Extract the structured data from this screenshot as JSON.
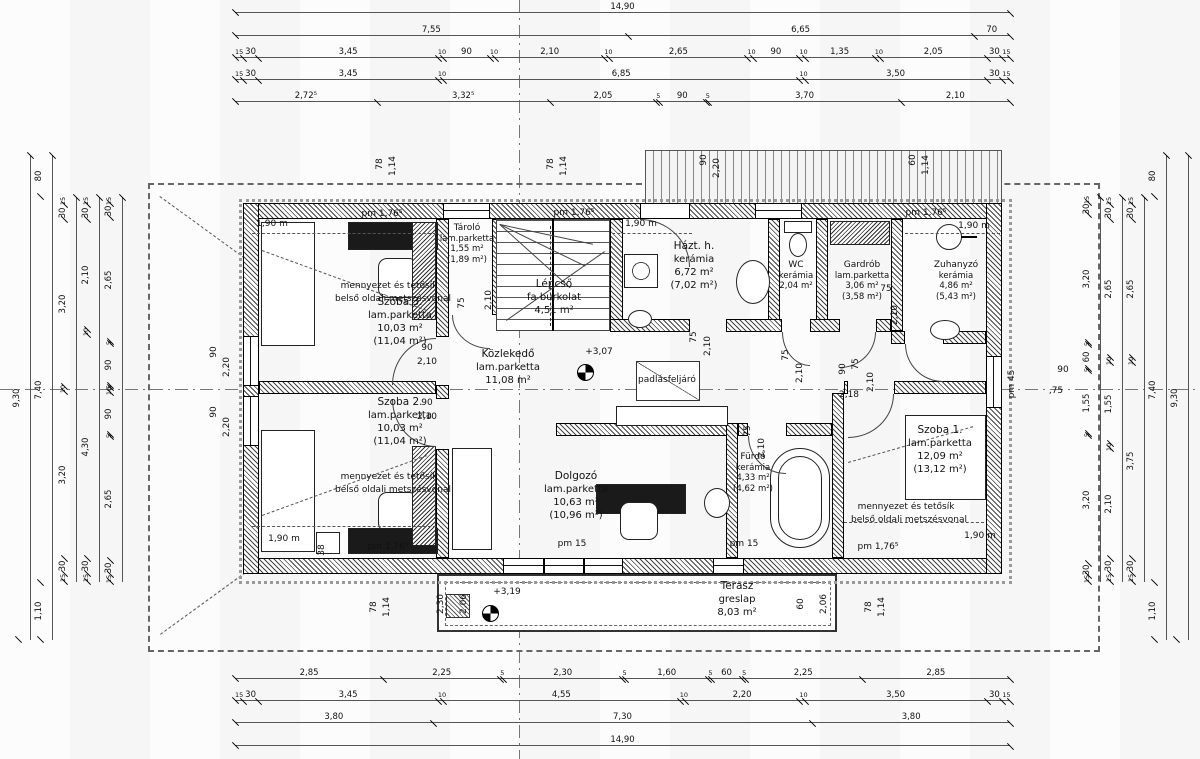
{
  "rooms": [
    {
      "name": "Szoba 3.",
      "finish": "lam.parketta",
      "area": "10,03 m²",
      "area2": "(11,04 m²)"
    },
    {
      "name": "Tároló",
      "finish": "lam.parketta",
      "area": "1,55 m²",
      "area2": "(1,89 m²)"
    },
    {
      "name": "Lépcső",
      "finish": "fa burkolat",
      "area": "4,51 m²",
      "area2": ""
    },
    {
      "name": "Házt. h.",
      "finish": "kerámia",
      "area": "6,72 m²",
      "area2": "(7,02 m²)"
    },
    {
      "name": "WC",
      "finish": "kerámia",
      "area": "2,04 m²",
      "area2": ""
    },
    {
      "name": "Gardrób",
      "finish": "lam.parketta",
      "area": "3,06 m²",
      "area2": "(3,58 m²)"
    },
    {
      "name": "Zuhanyzó",
      "finish": "kerámia",
      "area": "4,86 m²",
      "area2": "(5,43 m²)"
    },
    {
      "name": "Közlekedő",
      "finish": "lam.parketta",
      "area": "11,08 m²",
      "area2": ""
    },
    {
      "name": "Szoba 2.",
      "finish": "lam.parketta",
      "area": "10,03 m²",
      "area2": "(11,04 m²)"
    },
    {
      "name": "Dolgozó",
      "finish": "lam.parketta",
      "area": "10,63 m²",
      "area2": "(10,96 m²)"
    },
    {
      "name": "Fürdő",
      "finish": "kerámia",
      "area": "4,33 m²",
      "area2": "(4,62 m²)"
    },
    {
      "name": "Szoba 1.",
      "finish": "lam.parketta",
      "area": "12,09 m²",
      "area2": "(13,12 m²)"
    },
    {
      "name": "Terasz",
      "finish": "greslap",
      "area": "8,03 m²",
      "area2": ""
    }
  ],
  "dims": {
    "top": [
      [
        "14,90"
      ],
      [
        "7,55",
        "6,65",
        "70"
      ],
      [
        "15",
        "30",
        "3,45",
        "10",
        "90",
        "10",
        "2,10",
        "10",
        "2,65",
        "10",
        "90",
        "10",
        "1,35",
        "10",
        "2,05",
        "30",
        "15"
      ],
      [
        "15",
        "30",
        "3,45",
        "10",
        "6,85",
        "10",
        "3,50",
        "30",
        "15"
      ],
      [
        "2,72⁵",
        "3,32⁵",
        "2,05",
        "5",
        "90",
        "5",
        "3,70",
        "2,10"
      ]
    ],
    "bottom": [
      [
        "2,85",
        "2,25",
        "5",
        "2,30",
        "5",
        "1,60",
        "5",
        "60",
        "5",
        "2,25",
        "2,85"
      ],
      [
        "15",
        "30",
        "3,45",
        "10",
        "4,55",
        "10",
        "2,20",
        "10",
        "3,50",
        "30",
        "15"
      ],
      [
        "3,80",
        "7,30",
        "3,80"
      ],
      [
        "14,90"
      ]
    ],
    "left": [
      [
        "9,30"
      ],
      [
        "80",
        "7,40",
        "1,10"
      ],
      [
        "15",
        "30",
        "3,20",
        "10",
        "3,20",
        "30",
        "15"
      ],
      [
        "15",
        "30",
        "2,10",
        "10",
        "4,30",
        "30",
        "15"
      ],
      [
        "15",
        "30",
        "2,65",
        "5",
        "90",
        "5",
        "10",
        "90",
        "5",
        "2,65",
        "30",
        "15"
      ]
    ],
    "right": [
      [
        "15",
        "30",
        "3,20",
        "5",
        "60",
        "5",
        "1,55",
        "5",
        "3,20",
        "30",
        "15"
      ],
      [
        "15",
        "30",
        "2,65",
        "10",
        "1,55",
        "10",
        "2,10",
        "30",
        "15"
      ],
      [
        "15",
        "30",
        "2,65",
        "10",
        "3,75",
        "30",
        "15"
      ],
      [
        "80",
        "7,40",
        "1,10"
      ],
      [
        "9,30"
      ]
    ]
  },
  "labels": [
    {
      "t": "pm 1,76⁵",
      "x": 382,
      "y": 214,
      "r": 0
    },
    {
      "t": "pm 1,76⁵",
      "x": 574,
      "y": 213,
      "r": 0
    },
    {
      "t": "pm 1,76⁵",
      "x": 926,
      "y": 213,
      "r": 0
    },
    {
      "t": "pm 1,76⁵",
      "x": 388,
      "y": 547,
      "r": 0
    },
    {
      "t": "pm 1,76⁵",
      "x": 878,
      "y": 547,
      "r": 0
    },
    {
      "t": "pm 15",
      "x": 572,
      "y": 544,
      "r": 0
    },
    {
      "t": "pm 15",
      "x": 744,
      "y": 544,
      "r": 0
    },
    {
      "t": "pm 45",
      "x": 1012,
      "y": 384,
      "r": -90
    },
    {
      "t": "1,90 m",
      "x": 272,
      "y": 224,
      "r": 0
    },
    {
      "t": "1,90 m",
      "x": 641,
      "y": 224,
      "r": 0
    },
    {
      "t": "1,90 m",
      "x": 974,
      "y": 226,
      "r": 0
    },
    {
      "t": "1,90 m",
      "x": 284,
      "y": 539,
      "r": 0
    },
    {
      "t": "1,90 m",
      "x": 980,
      "y": 536,
      "r": 0
    },
    {
      "t": "+3,07",
      "x": 599,
      "y": 352,
      "r": 0
    },
    {
      "t": "+3,19",
      "x": 507,
      "y": 592,
      "r": 0
    },
    {
      "t": "padlásfeljáró",
      "x": 667,
      "y": 380,
      "r": 0
    },
    {
      "t": "mennyezet és tetősík",
      "x": 389,
      "y": 286,
      "r": 0
    },
    {
      "t": "belső oldali metszésvonal",
      "x": 393,
      "y": 299,
      "r": 0
    },
    {
      "t": "mennyezet és tetősík",
      "x": 389,
      "y": 477,
      "r": 0
    },
    {
      "t": "belső oldali metszésvonal",
      "x": 393,
      "y": 490,
      "r": 0
    },
    {
      "t": "mennyezet és tetősík",
      "x": 906,
      "y": 507,
      "r": 0
    },
    {
      "t": "belső oldali metszésvonal",
      "x": 909,
      "y": 520,
      "r": 0
    },
    {
      "t": "90",
      "x": 214,
      "y": 352,
      "r": -90
    },
    {
      "t": "2,20",
      "x": 227,
      "y": 367,
      "r": -90
    },
    {
      "t": "90",
      "x": 214,
      "y": 412,
      "r": -90
    },
    {
      "t": "2,20",
      "x": 227,
      "y": 427,
      "r": -90
    },
    {
      "t": "90",
      "x": 427,
      "y": 348,
      "r": 0
    },
    {
      "t": "2,10",
      "x": 427,
      "y": 362,
      "r": 0
    },
    {
      "t": "90",
      "x": 427,
      "y": 403,
      "r": 0
    },
    {
      "t": "2,10",
      "x": 427,
      "y": 417,
      "r": 0
    },
    {
      "t": "75",
      "x": 462,
      "y": 303,
      "r": -90
    },
    {
      "t": "2,10",
      "x": 489,
      "y": 300,
      "r": -90
    },
    {
      "t": "75",
      "x": 694,
      "y": 337,
      "r": -90
    },
    {
      "t": "2,10",
      "x": 708,
      "y": 346,
      "r": -90
    },
    {
      "t": "75",
      "x": 786,
      "y": 355,
      "r": -90
    },
    {
      "t": "2,10",
      "x": 800,
      "y": 373,
      "r": -90
    },
    {
      "t": "90",
      "x": 843,
      "y": 369,
      "r": -90
    },
    {
      "t": "75",
      "x": 856,
      "y": 364,
      "r": -90
    },
    {
      "t": "2,18",
      "x": 849,
      "y": 395,
      "r": 0
    },
    {
      "t": "2,10",
      "x": 871,
      "y": 382,
      "r": -90
    },
    {
      "t": "90",
      "x": 1063,
      "y": 370,
      "r": 0
    },
    {
      "t": ",75",
      "x": 1056,
      "y": 391,
      "r": 0
    },
    {
      "t": "78",
      "x": 380,
      "y": 164,
      "r": -90
    },
    {
      "t": "1,14",
      "x": 393,
      "y": 166,
      "r": -90
    },
    {
      "t": "78",
      "x": 551,
      "y": 164,
      "r": -90
    },
    {
      "t": "1,14",
      "x": 564,
      "y": 166,
      "r": -90
    },
    {
      "t": "90",
      "x": 704,
      "y": 160,
      "r": -90
    },
    {
      "t": "2,20",
      "x": 717,
      "y": 168,
      "r": -90
    },
    {
      "t": "60",
      "x": 913,
      "y": 160,
      "r": -90
    },
    {
      "t": "1,14",
      "x": 926,
      "y": 165,
      "r": -90
    },
    {
      "t": "78",
      "x": 374,
      "y": 607,
      "r": -90
    },
    {
      "t": "1,14",
      "x": 387,
      "y": 607,
      "r": -90
    },
    {
      "t": "2,30",
      "x": 441,
      "y": 604,
      "r": -90
    },
    {
      "t": "2,06",
      "x": 464,
      "y": 604,
      "r": -90
    },
    {
      "t": "60",
      "x": 801,
      "y": 604,
      "r": -90
    },
    {
      "t": "2,06",
      "x": 824,
      "y": 604,
      "r": -90
    },
    {
      "t": "78",
      "x": 869,
      "y": 607,
      "r": -90
    },
    {
      "t": "1,14",
      "x": 882,
      "y": 607,
      "r": -90
    },
    {
      "t": "38",
      "x": 322,
      "y": 550,
      "r": -90
    },
    {
      "t": "75",
      "x": 886,
      "y": 289,
      "r": 0
    },
    {
      "t": "2,10",
      "x": 895,
      "y": 315,
      "r": -90
    },
    {
      "t": "75",
      "x": 748,
      "y": 431,
      "r": -90
    },
    {
      "t": "2,10",
      "x": 762,
      "y": 448,
      "r": -90
    }
  ]
}
